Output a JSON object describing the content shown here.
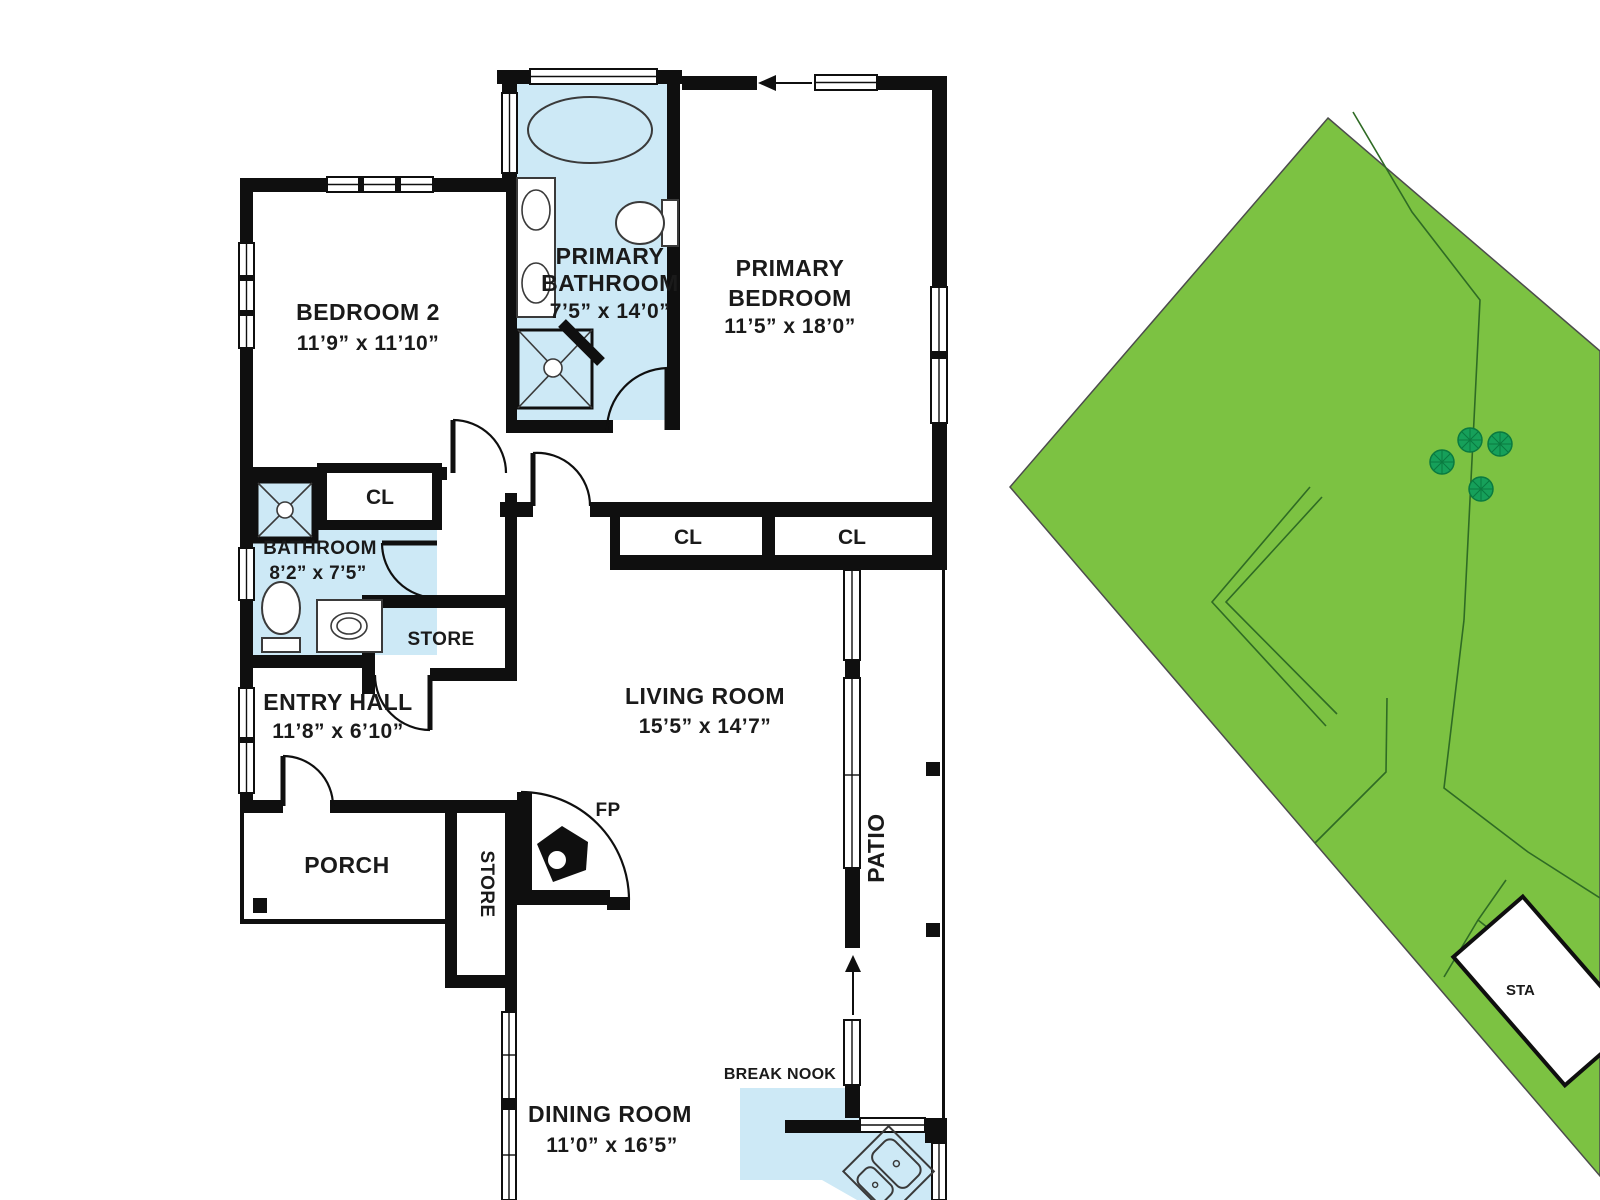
{
  "labels": {
    "primary_bathroom": {
      "line1": "PRIMARY",
      "line2": "BATHROOM",
      "dims": "7’5” x 14’0”"
    },
    "primary_bedroom": {
      "line1": "PRIMARY",
      "line2": "BEDROOM",
      "dims": "11’5” x 18’0”"
    },
    "bedroom2": {
      "line1": "BEDROOM 2",
      "dims": "11’9” x 11’10”"
    },
    "bathroom": {
      "line1": "BATHROOM",
      "dims": "8’2” x 7’5”"
    },
    "entry_hall": {
      "line1": "ENTRY HALL",
      "dims": "11’8” x 6’10”"
    },
    "living_room": {
      "line1": "LIVING ROOM",
      "dims": "15’5” x 14’7”"
    },
    "dining_room": {
      "line1": "DINING ROOM",
      "dims": "11’0” x 16’5”"
    },
    "porch": "PORCH",
    "patio": "PATIO",
    "break_nook": "BREAK NOOK",
    "store_hall": "STORE",
    "store_porch": "STORE",
    "fireplace": "FP",
    "closet_bedroom2": "CL",
    "closet_primary_1": "CL",
    "closet_primary_2": "CL",
    "stairs_partial": "STA"
  },
  "colors": {
    "wall": "#0f0f0f",
    "wet_room_fill": "#cde9f6",
    "lawn_fill": "#7cc242",
    "tree_fill": "#16a05a",
    "tree_stroke": "#0a7a40"
  }
}
